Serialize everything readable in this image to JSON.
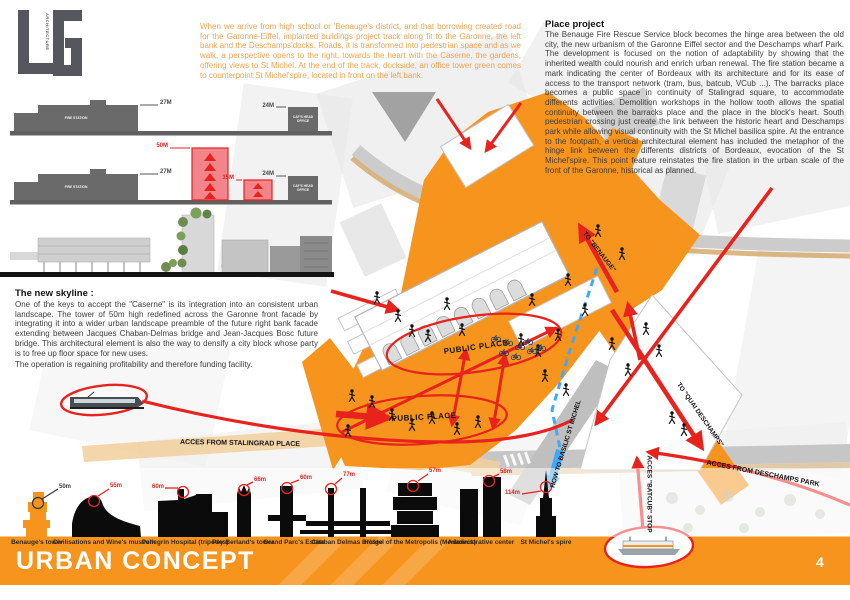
{
  "logo": {
    "vertical_text": "ARCHITECTURE"
  },
  "intro": {
    "text": "When we arrive from high school or 'Benauge's district, and that borrowing created road for the Garonne-Eiffel, implanted buildings project track along fit to the Garonne, the left bank and the Deschamps'docks. Roads, it is transformed into pedestrian space and as we walk, a perspective opens to the right, towards the heart with the Caserne, the gardens, offering views to St Michel. At the end of the track, dockside, an office tower green comes to counterpoint St Michel'spire, located in front on the left bank."
  },
  "place_project": {
    "title": "Place project",
    "body": "The Benauge Fire Rescue Service block becomes the hinge area between the old city, the new urbanism of the Garonne Eiffel sector and the Deschamps wharf Park. The development is focused on the notion of adaptability by showing that the inherited wealth could nourish and enrich urban renewal. The fire station became a mark indicating the center of Bordeaux with its architecture and for its ease of access to the transport network (tram, bus, batcub, VCub ...). The barracks place becomes a public space in continuity of Stalingrad square, to accommodate differents activities. Demolition workshops in the hollow tooth allows the spatial continuity between the barracks place and the place in the block's heart. South pedestrian crossing just create the link between the historic heart and Deschamps park while allowing visual continuity with the St Michel basilica spire. At the entrance to the footpath, a vertical architectural element has included the metaphor of the hinge link between the differents districts of Bordeaux, evocation of the St Michel'spire. This point feature reinstates the fire station in the urban scale of the front of the Garonne, historical as planned."
  },
  "new_skyline": {
    "title": "The new skyline :",
    "body1": "One of the keys to accept the \"Caserne\" is its integration into an consistent urban landscape. The tower of 50m high redefined across the Garonne front facade by integrating it into a wider urban landscape preamble of the future right bank facade extending between Jacques Chaban-Delmas bridge and Jean-Jacques Bosc future bridge. This architectural element is also the way to densify a city block whose party is to free up floor space for new uses.",
    "body2": "The operation is regaining profitability and therefore funding facility."
  },
  "sections": {
    "fire_station": "FIRE STATION",
    "head_office": "CAF'S HEAD OFFICE",
    "dim_fire_1": "27M",
    "dim_office_1": "24M",
    "dim_fire_2": "27M",
    "dim_tower": "50M",
    "dim_small_tower": "15M",
    "dim_office_2": "24M"
  },
  "map": {
    "public_place_upper": "PUBLIC PLACE",
    "public_place_lower": "PUBLIC PLACE",
    "to_benauge": "TO \"BENAUGE\"",
    "to_quai_deschamps": "TO \"QUAI DESCHAMPS\"",
    "how_to_basilic": "HOW TO BASILIC ST MICHEL",
    "acces_stalingrad": "ACCES FROM STALINGRAD PLACE",
    "acces_deschamps": "ACCES FROM DESCHAMPS PARK",
    "acces_batcub": "ACCES \"BATCUB\" STOP"
  },
  "skyline": {
    "items": [
      {
        "label": "Benauge's tower",
        "height": "50m"
      },
      {
        "label": "Civilisations and Wine's museum",
        "height": "55m"
      },
      {
        "label": "Pellegrin Hospital (tripodes)",
        "height": "60m"
      },
      {
        "label": "Pey Berland's tower",
        "height": "66m"
      },
      {
        "label": "Grand Parc's Estate",
        "height": "60m"
      },
      {
        "label": "Chaban Delmas Bridge",
        "height": "77m"
      },
      {
        "label": "Hostel of the Metropolis (Mériadeck)",
        "height": "57m"
      },
      {
        "label": "Administrative center",
        "height": "58m"
      },
      {
        "label": "St Michel's spire",
        "height": "114m"
      }
    ]
  },
  "footer": {
    "title": "URBAN CONCEPT",
    "page": "4"
  },
  "colors": {
    "orange": "#F7941E",
    "red": "#E8221C",
    "blue": "#3FA9F5"
  }
}
